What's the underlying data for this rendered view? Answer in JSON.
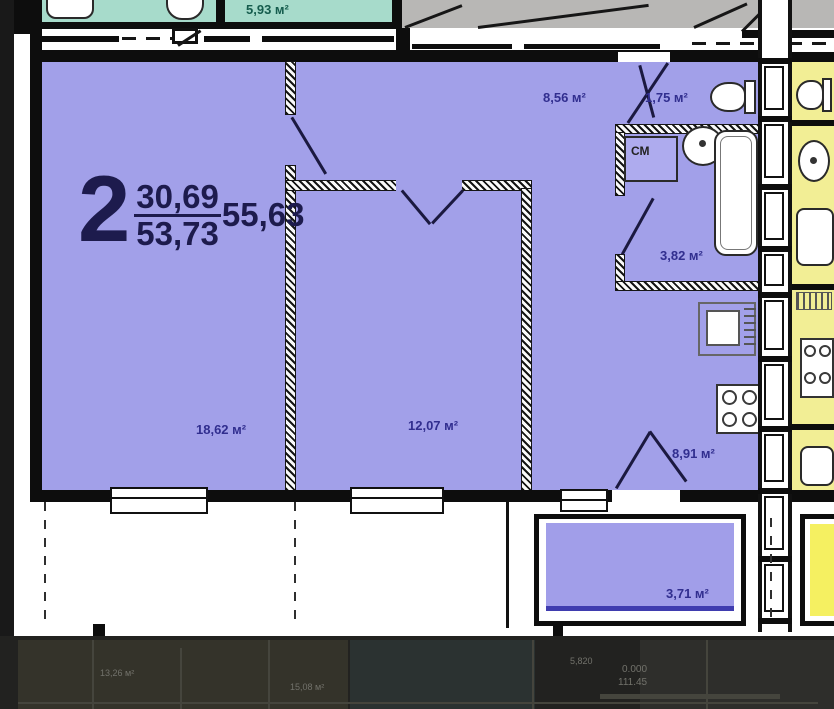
{
  "apartment": {
    "number": "2",
    "living_area": "30,69",
    "total_area": "53,73",
    "full_area": "55,63"
  },
  "rooms": {
    "living": "18,62 м²",
    "bedroom": "12,07 м²",
    "hallway": "8,56 м²",
    "wc": "1,75 м²",
    "bathroom": "3,82 м²",
    "kitchen": "8,91 м²",
    "balcony": "3,71 м²",
    "neighbor_top": "5,93 м²"
  },
  "annotations": {
    "washing_machine": "СМ"
  },
  "underlay": {
    "elevation": "0.000",
    "area_value": "111.45",
    "dimension": "5,820",
    "room_a": "13,26 м²",
    "room_b": "15,08 м²"
  },
  "colors": {
    "apartment_fill": "#a2a0e9",
    "balcony_fill": "#a19ee9",
    "neighbor_fill": "#f2ee95",
    "neighbor_balcony_fill": "#f5f061",
    "top_room_fill": "#a7dbcb",
    "top_room_text": "#155c4d",
    "wall": "#0d0d0d",
    "label_text": "#312e8f",
    "corridor_gray": "#b8b7b5",
    "underlay_bg": "#222220"
  }
}
